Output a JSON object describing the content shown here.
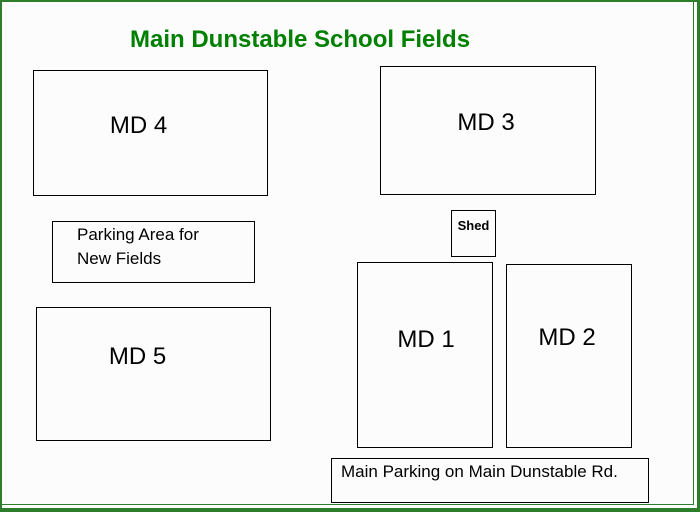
{
  "title": {
    "text": "Main Dunstable School Fields"
  },
  "colors": {
    "frame_green": "#2d7d2d",
    "title_green": "#008000",
    "box_border": "#000000",
    "background": "#fcfcfc"
  },
  "fields": {
    "md4": {
      "label": "MD 4"
    },
    "md3": {
      "label": "MD 3"
    },
    "md5": {
      "label": "MD 5"
    },
    "md1": {
      "label": "MD 1"
    },
    "md2": {
      "label": "MD 2"
    }
  },
  "shed": {
    "label": "Shed"
  },
  "parking_new_fields": {
    "lines": [
      "Parking Area for",
      "New Fields"
    ]
  },
  "parking_main": {
    "text": "Main Parking on Main Dunstable Rd."
  }
}
